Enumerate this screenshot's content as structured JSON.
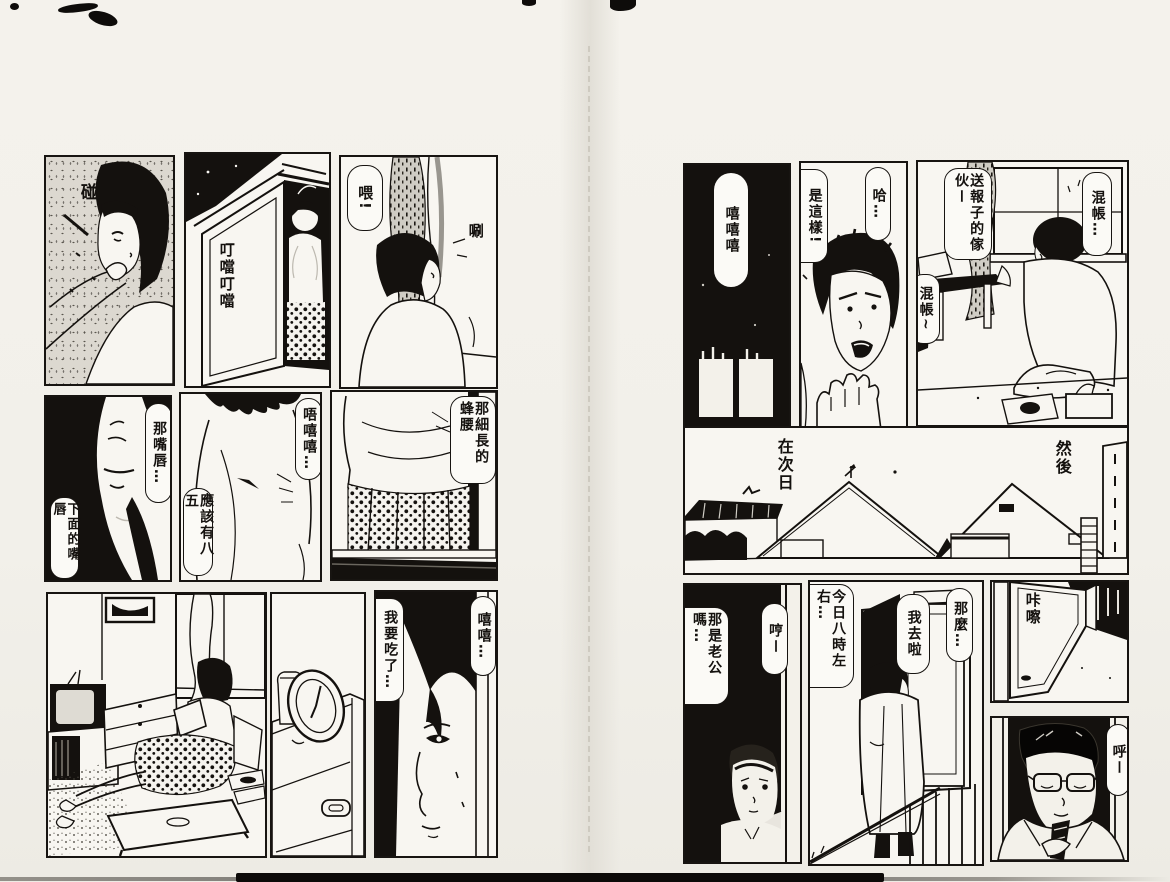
{
  "document": {
    "kind_label": "manga two-page spread",
    "colors": {
      "paper": "#f2f0ea",
      "ink": "#14110e"
    }
  },
  "left_page": {
    "panel_makeup": {
      "sfx": "碰"
    },
    "panel_window": {
      "sfx": "叮噹叮噹"
    },
    "panel_curtain": {
      "bubble_greeting": "喂!",
      "sfx": "唰"
    },
    "panel_lips": {
      "bubble_top": "那嘴唇…",
      "bubble_bottom": "下面的嘴唇"
    },
    "panel_chest": {
      "bubble_top": "唔嘻嘻…",
      "bubble_bottom": "應該有八五"
    },
    "panel_waist": {
      "bubble_top": "那細長的蜂腰"
    },
    "panel_face": {
      "bubble_left": "我要吃了…",
      "bubble_right": "嘻嘻…"
    }
  },
  "right_page": {
    "panel_night": {
      "bubble_laugh": "嘻嘻嘻"
    },
    "panel_shock": {
      "bubble_left": "是這樣!",
      "bubble_right": "哈…"
    },
    "panel_table": {
      "bubble_left": "送報子的傢伙ー",
      "bubble_mid": "混帳~",
      "bubble_right": "混帳…"
    },
    "panel_skyline": {
      "caption_left": "在次日",
      "caption_right": "然後"
    },
    "panel_peek": {
      "bubble_right": "哼ー",
      "bubble_left": "那是老公嗎…"
    },
    "panel_leaving": {
      "bubble_right": "那麼…",
      "bubble_mid": "我去啦",
      "bubble_left": "今日八時左右…"
    },
    "panel_door": {
      "sfx": "咔嚓"
    },
    "panel_sigh": {
      "bubble": "呼ー"
    }
  }
}
